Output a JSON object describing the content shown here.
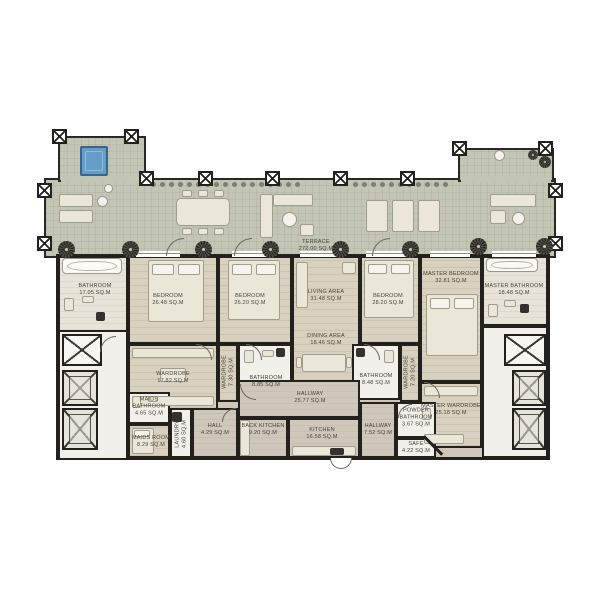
{
  "palette": {
    "wall": "#23211c",
    "terrace_floor": "#c4c6b5",
    "wood_floor": "#d8d1c0",
    "hall_floor": "#cdc8ba",
    "white_room": "#f2f0ea",
    "furniture": "#ebe7d8",
    "spa_blue": "#649dc6",
    "plant_dark": "#26251f",
    "label_text": "#45433c"
  },
  "rooms": {
    "terrace": {
      "name": "TERRACE",
      "area": "272.00 SQ.M"
    },
    "bathroom1": {
      "name": "BATHROOM",
      "area": "17.05 SQ.M"
    },
    "bedroom1": {
      "name": "BEDROOM",
      "area": "26.48 SQ.M"
    },
    "bedroom2": {
      "name": "BEDROOM",
      "area": "26.20 SQ.M"
    },
    "living": {
      "name": "LIVING AREA",
      "area": "31.48 SQ.M"
    },
    "dining": {
      "name": "DINING AREA",
      "area": "18.46 SQ.M"
    },
    "bedroom3": {
      "name": "BEDROOM",
      "area": "28.20 SQ.M"
    },
    "master_bedroom": {
      "name": "MASTER BEDROOM",
      "area": "32.81 SQ.M"
    },
    "master_bathroom": {
      "name": "MASTER BATHROOM",
      "area": "18.48 SQ.M"
    },
    "wardrobe1": {
      "name": "WARDROBE",
      "area": "17.82 SQ.M"
    },
    "wardrobe2": {
      "name": "WARDROBE",
      "area": "7.30 SQ.M"
    },
    "bathroom2": {
      "name": "BATHROOM",
      "area": "8.85 SQ.M"
    },
    "bathroom3": {
      "name": "BATHROOM",
      "area": "8.48 SQ.M"
    },
    "wardrobe3": {
      "name": "WARDROBE",
      "area": "7.20 SQ.M"
    },
    "master_wardrobe": {
      "name": "MASTER WARDROBE",
      "area": "25.18 SQ.M"
    },
    "maids_bathroom": {
      "name": "MAIDS BATHROOM",
      "area": "4.65 SQ.M"
    },
    "maids_room": {
      "name": "MAIDS ROOM",
      "area": "8.29 SQ.M"
    },
    "laundry": {
      "name": "LAUNDRY",
      "area": "4.60 SQ.M"
    },
    "hall": {
      "name": "HALL",
      "area": "4.29 SQ.M"
    },
    "back_kitchen": {
      "name": "BACK KITCHEN",
      "area": "9.20 SQ.M"
    },
    "hallway1": {
      "name": "HALLWAY",
      "area": "25.77 SQ.M"
    },
    "kitchen": {
      "name": "KITCHEN",
      "area": "16.58 SQ.M"
    },
    "hallway2": {
      "name": "HALLWAY",
      "area": "7.52 SQ.M"
    },
    "powder_bathroom": {
      "name": "POWDER BATHROOM",
      "area": "3.67 SQ.M"
    },
    "safe": {
      "name": "SAFE",
      "area": "4.22 SQ.M"
    }
  }
}
